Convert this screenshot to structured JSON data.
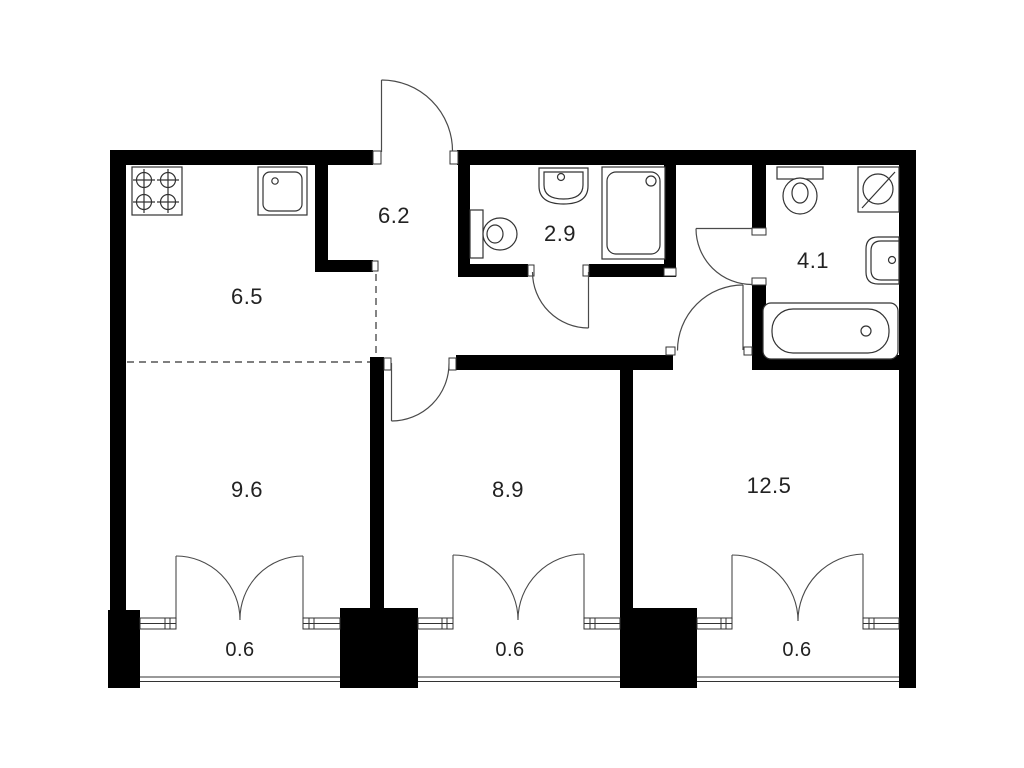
{
  "plan": {
    "title": "Two-room apartment floor plan",
    "colors": {
      "wall": "#000000",
      "line": "#3a3a3a",
      "background": "#ffffff",
      "text": "#222222"
    },
    "rooms": [
      {
        "name": "kitchen-living",
        "area": "6.5"
      },
      {
        "name": "hallway",
        "area": "6.2"
      },
      {
        "name": "shower-room",
        "area": "2.9"
      },
      {
        "name": "bathroom",
        "area": "4.1"
      },
      {
        "name": "bedroom-left",
        "area": "9.6"
      },
      {
        "name": "bedroom-middle",
        "area": "8.9"
      },
      {
        "name": "bedroom-right",
        "area": "12.5"
      },
      {
        "name": "balcony-left",
        "area": "0.6"
      },
      {
        "name": "balcony-middle",
        "area": "0.6"
      },
      {
        "name": "balcony-right",
        "area": "0.6"
      }
    ],
    "fixtures": [
      "stove-icon",
      "kitchen-sink-icon",
      "toilet-icon",
      "washbasin-icon",
      "shower-tray-icon",
      "washing-machine-icon",
      "bathtub-icon"
    ]
  }
}
